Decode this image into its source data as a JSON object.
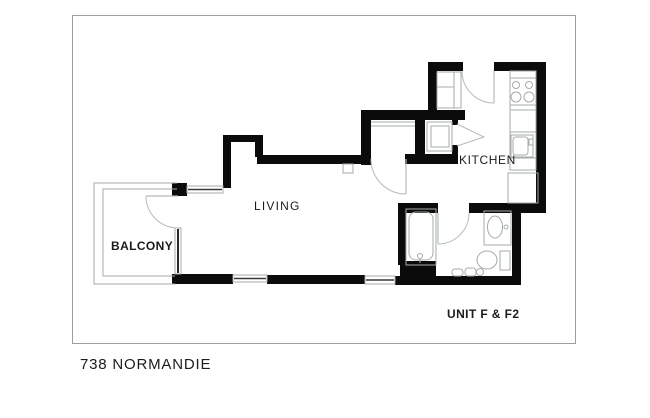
{
  "title": "738 NORMANDIE",
  "plan": {
    "unit_label": "UNIT F & F2",
    "room_labels": {
      "living": "LIVING",
      "kitchen": "KITCHEN",
      "balcony": "BALCONY"
    }
  },
  "colors": {
    "wall": "#0b0b0b",
    "fixture": "#a6abad",
    "arc": "#b4babc",
    "frame": "#98a0a3",
    "text": "#1b1b1b"
  }
}
